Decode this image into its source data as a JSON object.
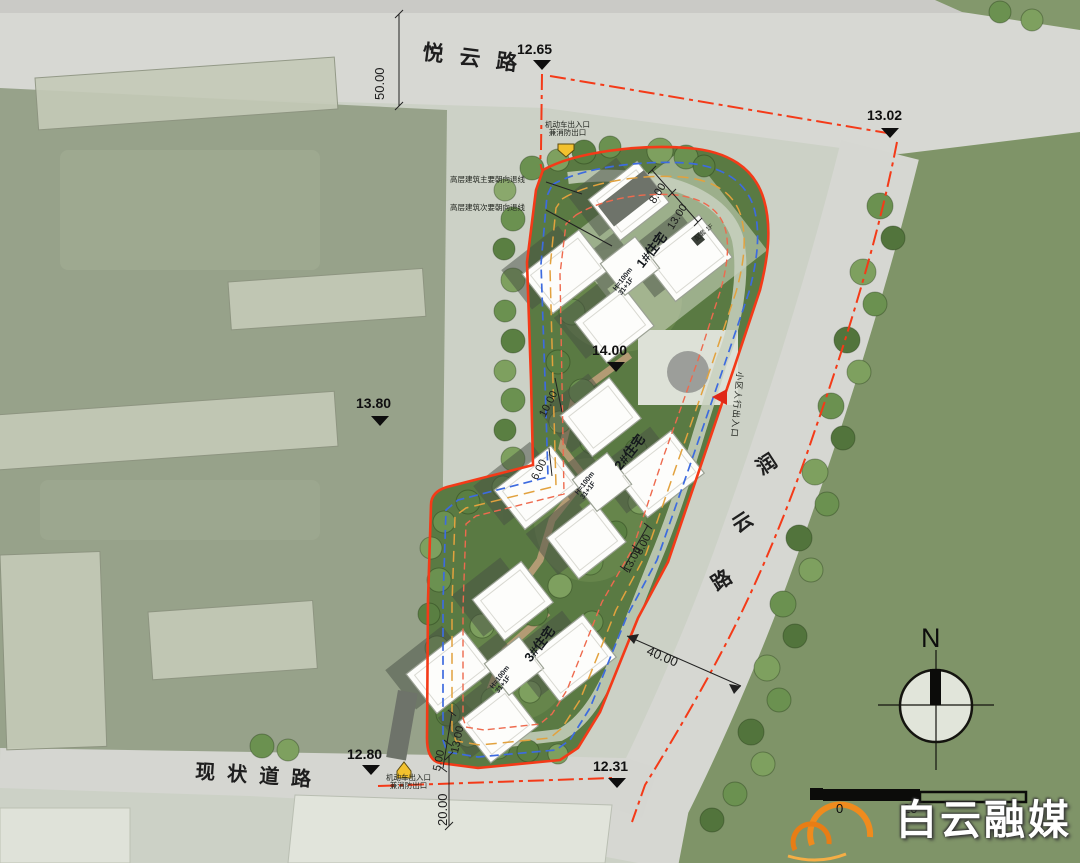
{
  "roads": {
    "top": "悦云路",
    "right_chars": [
      "润",
      "云",
      "路"
    ],
    "bottom": "现状道路"
  },
  "elevations": {
    "top": "12.65",
    "top_right": "13.02",
    "west": "13.80",
    "center": "14.00",
    "bottom_left": "12.80",
    "bottom_right": "12.31"
  },
  "dimensions": {
    "north_offset": "50.00",
    "road_width": "40.00",
    "south_offset": "20.00",
    "west_upper": "10.00",
    "west_lower": "6.00",
    "top_inner": "8.00",
    "top_outer": "13.00",
    "east_inner": "8.00",
    "east_outer": "13.00",
    "south_inner": "5.00",
    "south_outer": "13.00"
  },
  "buildings": [
    {
      "label": "1#住宅",
      "height": "H=100m",
      "floors": "31+1F"
    },
    {
      "label": "2#住宅",
      "height": "H=100m",
      "floors": "31+1F"
    },
    {
      "label": "3#住宅",
      "height": "H=100m",
      "floors": "31+1F"
    }
  ],
  "annotations": {
    "setback_main": "高层建筑主要朝向退线",
    "setback_secondary": "高层建筑次要朝向退线",
    "vehicle_exit_line1": "机动车出入口",
    "vehicle_exit_line2": "兼消防出口",
    "pedestrian_entrance": "小区人行出入口",
    "ancillary": "配套 1F"
  },
  "compass_label": "N",
  "scale_bar": {
    "zero": "0",
    "twenty": "20"
  },
  "watermark": "白云融媒",
  "colors": {
    "boundary_red": "#f43a18",
    "setback_blue": "#3d6bdf",
    "setback_orange": "#e2a23e",
    "setback_red_dash": "#ee6a4e",
    "entrance_yellow": "#f2c12e",
    "entrance_red": "#e02818",
    "logo_orange": "#ef8b1d"
  }
}
